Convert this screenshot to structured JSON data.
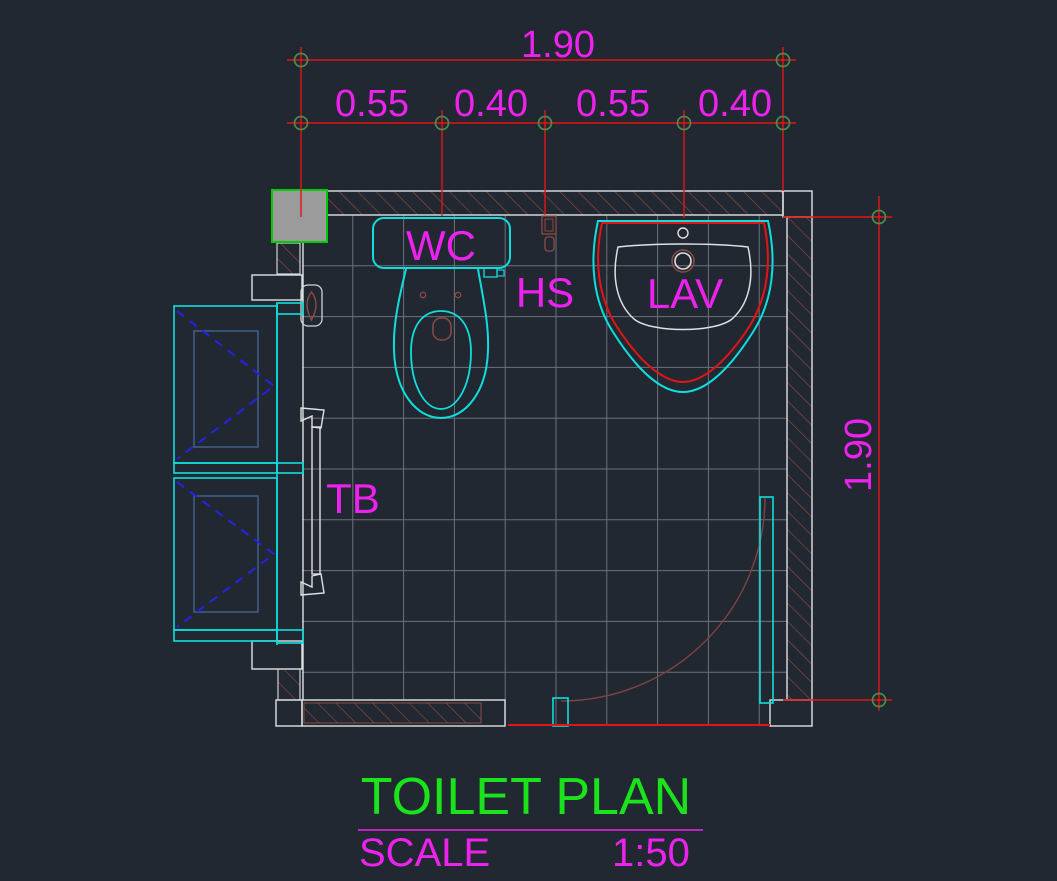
{
  "drawing": {
    "dimensions": {
      "top_total": "1.90",
      "top_segments": [
        "0.55",
        "0.40",
        "0.55",
        "0.40"
      ],
      "right_total": "1.90"
    },
    "labels": {
      "toilet": "WC",
      "hand_shower": "HS",
      "lavatory": "LAV",
      "towel_bar": "TB"
    },
    "title_block": {
      "title": "TOILET PLAN",
      "scale_label": "SCALE",
      "scale_value": "1:50"
    },
    "colors": {
      "background": "#222831",
      "dimension_red": "#e31414",
      "text_magenta": "#ee22ee",
      "title_green": "#1be31b",
      "fixture_cyan": "#0fdede",
      "wall_outline_white": "#dde1e4",
      "hatch_brown": "#8c4a42",
      "tile_grid_gray": "#6b717b",
      "marker_green": "#4d8a4d",
      "swing_symbol_blue": "#2222e8",
      "door_arc_brown": "#7d4242",
      "column_border_green": "#00cc00",
      "column_fill_gray": "#9b9b9b"
    }
  }
}
